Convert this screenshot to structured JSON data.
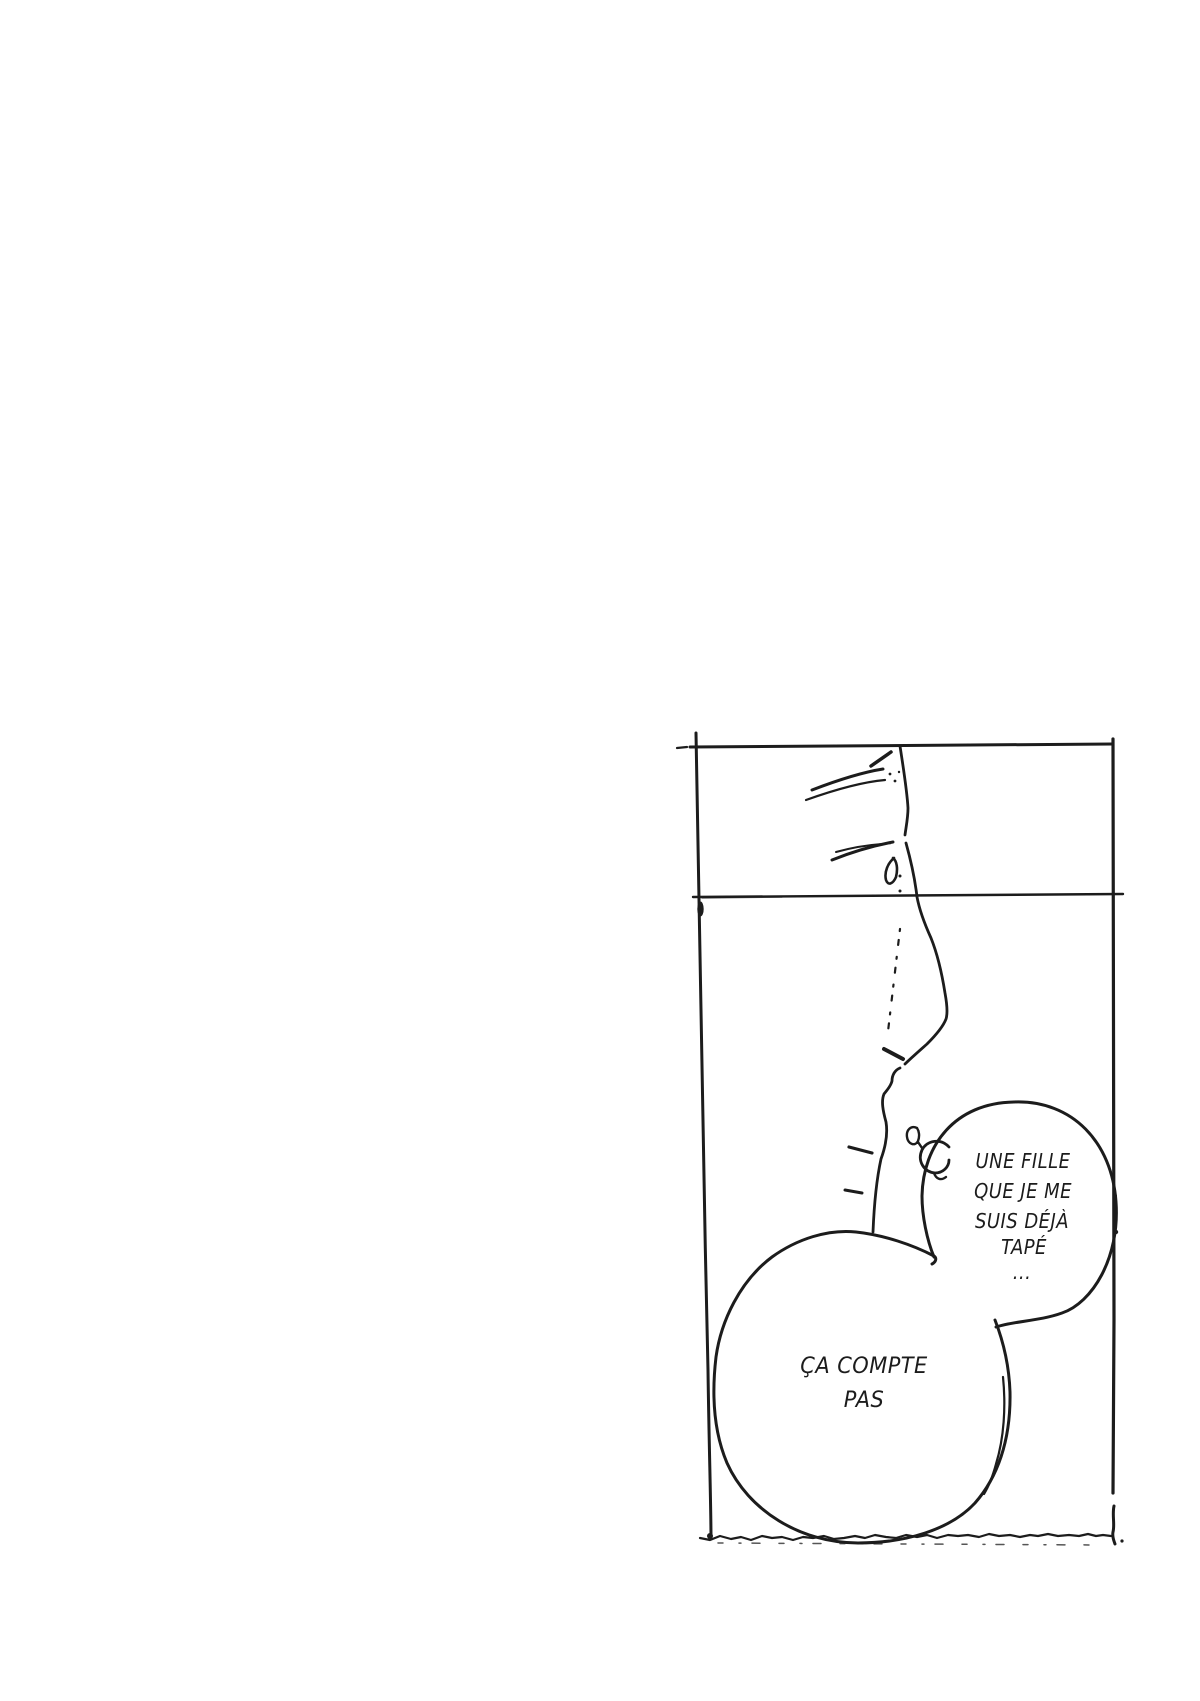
{
  "page": {
    "background_color": "#ffffff",
    "ink_color": "#1c1c1c"
  },
  "speech_bubbles": [
    {
      "name": "bubble-top-right",
      "lines": [
        "UNE FILLE",
        "QUE JE ME",
        "SUIS DÉJÀ",
        "TAPÉ",
        "..."
      ]
    },
    {
      "name": "bubble-bottom",
      "lines": [
        "ÇA COMPTE",
        "PAS"
      ]
    }
  ]
}
